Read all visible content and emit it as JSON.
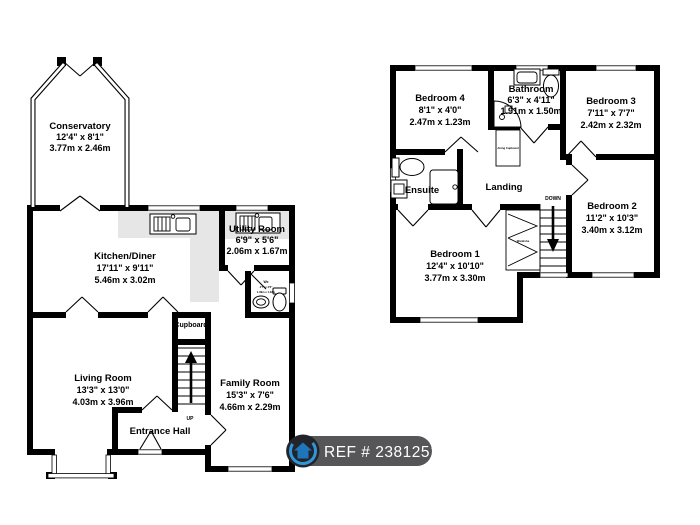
{
  "ground": {
    "conservatory": {
      "name": "Conservatory",
      "size_ft": "12'4\" x 8'1\"",
      "size_m": "3.77m x 2.46m"
    },
    "kitchen": {
      "name": "Kitchen/Diner",
      "size_ft": "17'11\" x 9'11\"",
      "size_m": "5.46m x 3.02m"
    },
    "utility": {
      "name": "Utility Room",
      "size_ft": "6'9\" x 5'6\"",
      "size_m": "2.06m x 1.67m"
    },
    "wc": {
      "name": "Wc",
      "size_ft": "4'7\" x 4'0\"",
      "size_m": "1.39m x 1.22m"
    },
    "living": {
      "name": "Living Room",
      "size_ft": "13'3\" x 13'0\"",
      "size_m": "4.03m x 3.96m"
    },
    "family": {
      "name": "Family Room",
      "size_ft": "15'3\" x 7'6\"",
      "size_m": "4.66m x 2.29m"
    },
    "entrance": {
      "name": "Entrance Hall"
    },
    "cupboard": {
      "name": "Cupboard"
    },
    "up_label": "UP"
  },
  "first": {
    "bedroom4": {
      "name": "Bedroom 4",
      "size_ft": "8'1\" x 4'0\"",
      "size_m": "2.47m x 1.23m"
    },
    "bathroom": {
      "name": "Bathroom",
      "size_ft": "6'3\" x 4'11\"",
      "size_m": "1.91m x 1.50m"
    },
    "bedroom3": {
      "name": "Bedroom 3",
      "size_ft": "7'11\" x 7'7\"",
      "size_m": "2.42m x 2.32m"
    },
    "bedroom2": {
      "name": "Bedroom 2",
      "size_ft": "11'2\" x 10'3\"",
      "size_m": "3.40m x 3.12m"
    },
    "bedroom1": {
      "name": "Bedroom 1",
      "size_ft": "12'4\" x 10'10\"",
      "size_m": "3.77m x 3.30m"
    },
    "ensuite": {
      "name": "Ensuite"
    },
    "landing": {
      "name": "Landing"
    },
    "airing": {
      "name": "Airing Cupboard"
    },
    "wardrobe": {
      "name": "Wardrobe"
    },
    "down_label": "DOWN"
  },
  "badge": {
    "ref_label": "REF # 2381251"
  },
  "colors": {
    "wall": "#000000",
    "counter": "#e6e6e6",
    "badge_bg": "#565659",
    "badge_text": "#ffffff",
    "logo_ring": "#2f96d8",
    "logo_house": "#1e76ba"
  }
}
